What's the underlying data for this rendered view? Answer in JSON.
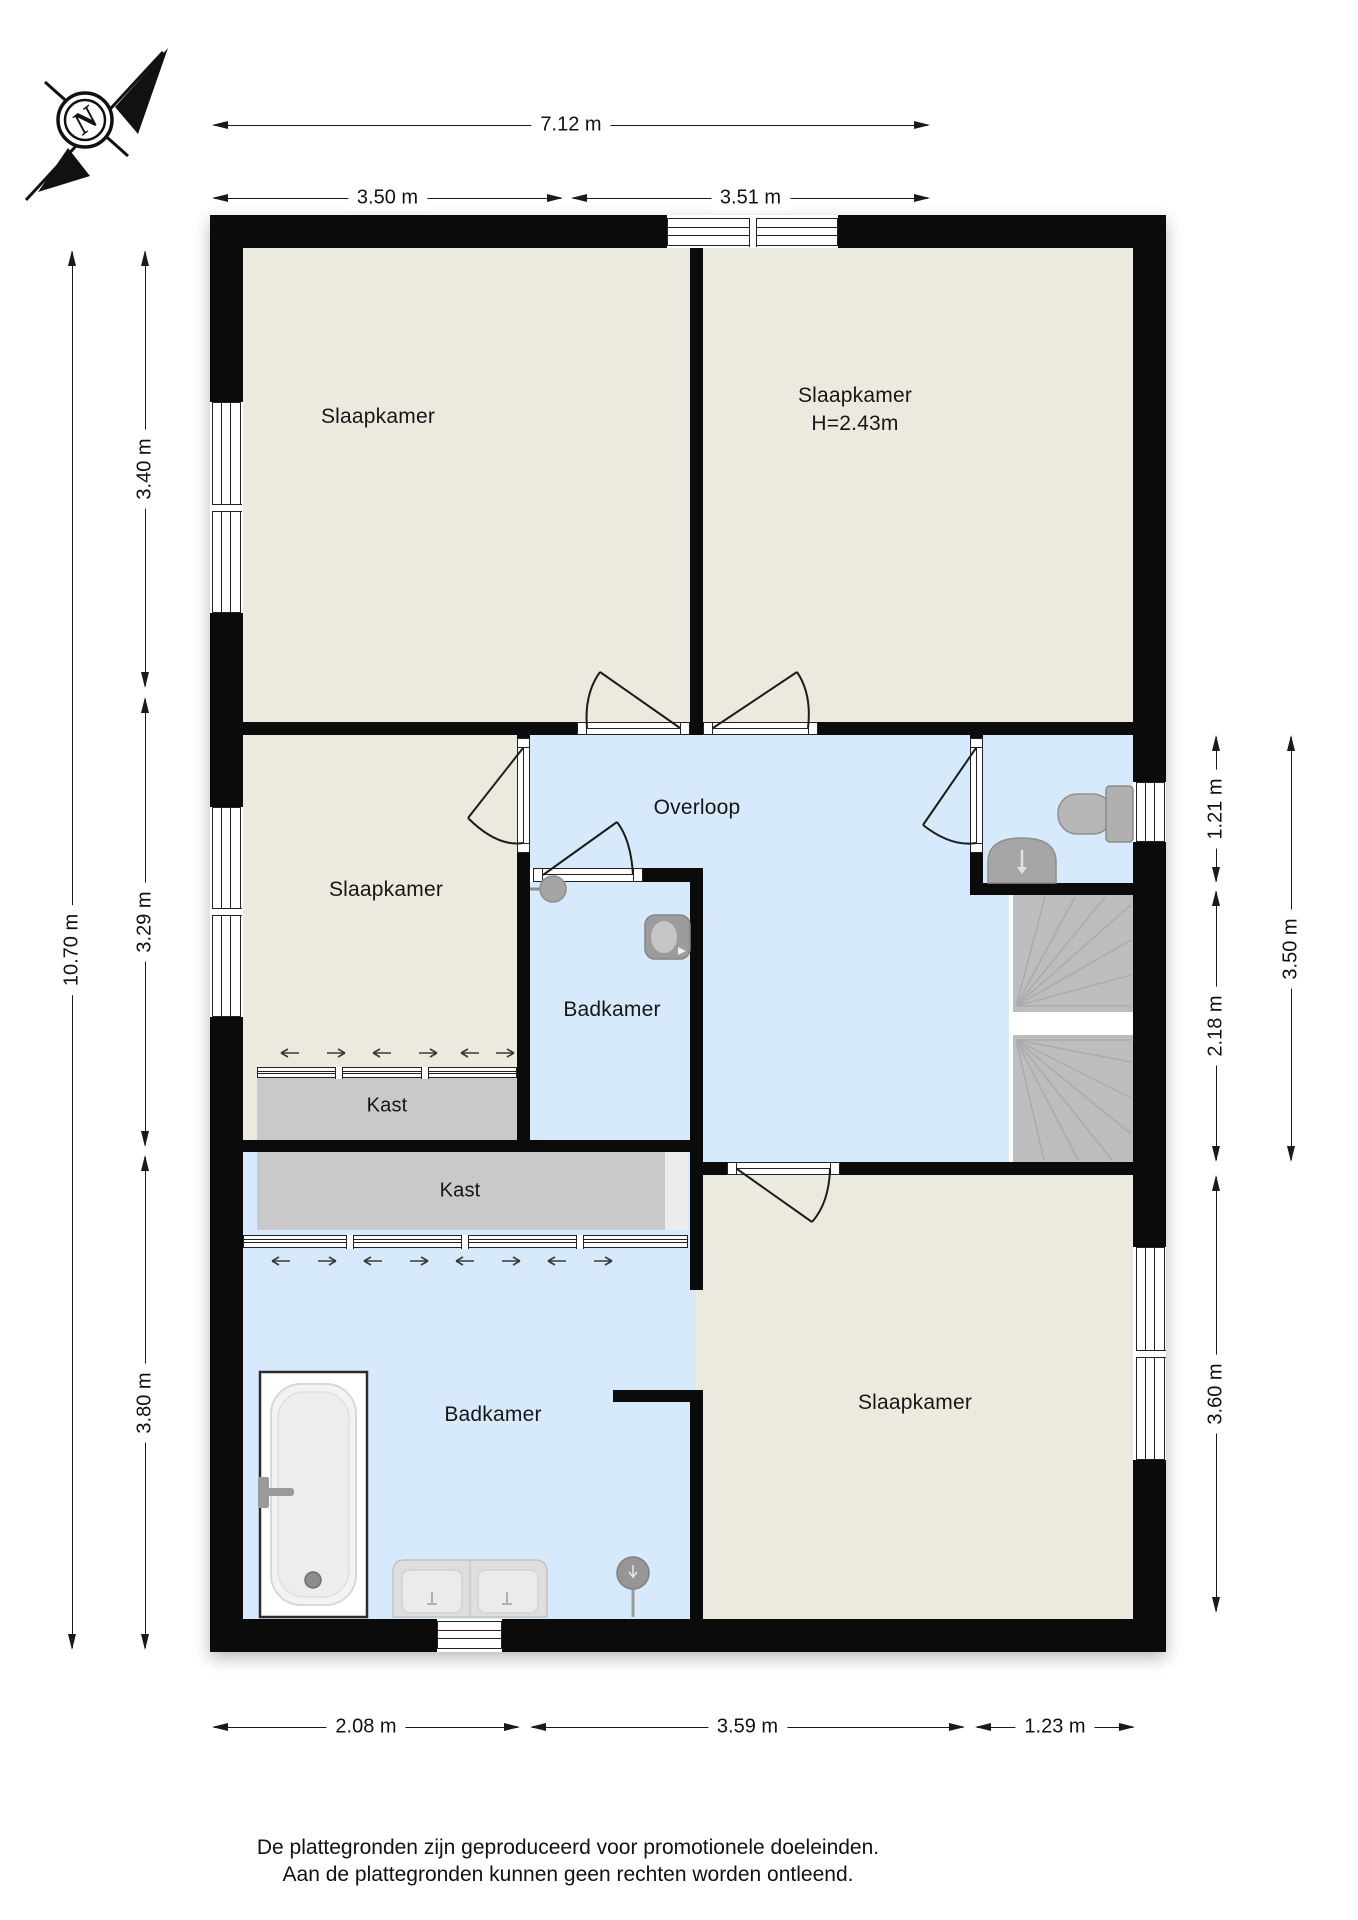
{
  "compass": {
    "label": "N"
  },
  "dimensions": {
    "top_total": "7.12 m",
    "top_left": "3.50 m",
    "top_right": "3.51 m",
    "left_total": "10.70 m",
    "left_upper": "3.40 m",
    "left_middle": "3.29 m",
    "left_lower": "3.80 m",
    "right_toilet": "1.21 m",
    "right_stairs": "2.18 m",
    "right_total": "3.50 m",
    "right_bedroom": "3.60 m",
    "bottom_left": "2.08 m",
    "bottom_middle": "3.59 m",
    "bottom_right": "1.23 m"
  },
  "rooms": {
    "bedroom_top_left": {
      "label": "Slaapkamer"
    },
    "bedroom_top_right": {
      "label": "Slaapkamer",
      "ceiling_height": "H=2.43m"
    },
    "bedroom_middle_left": {
      "label": "Slaapkamer"
    },
    "bathroom_middle": {
      "label": "Badkamer"
    },
    "landing": {
      "label": "Overloop"
    },
    "closet_upper": {
      "label": "Kast"
    },
    "closet_lower": {
      "label": "Kast"
    },
    "bathroom_bottom": {
      "label": "Badkamer"
    },
    "bedroom_bottom_right": {
      "label": "Slaapkamer"
    }
  },
  "footer": {
    "line1": "De plattegronden zijn geproduceerd voor promotionele doeleinden.",
    "line2": "Aan de plattegronden kunnen geen rechten worden ontleend."
  },
  "colors": {
    "wall": "#0B0B0B",
    "room_floor": "#ECEADF",
    "wet_room_floor": "#D6EAFC",
    "closet_fill": "#C9C9C9",
    "stairs_fill": "#BDBDBD"
  }
}
